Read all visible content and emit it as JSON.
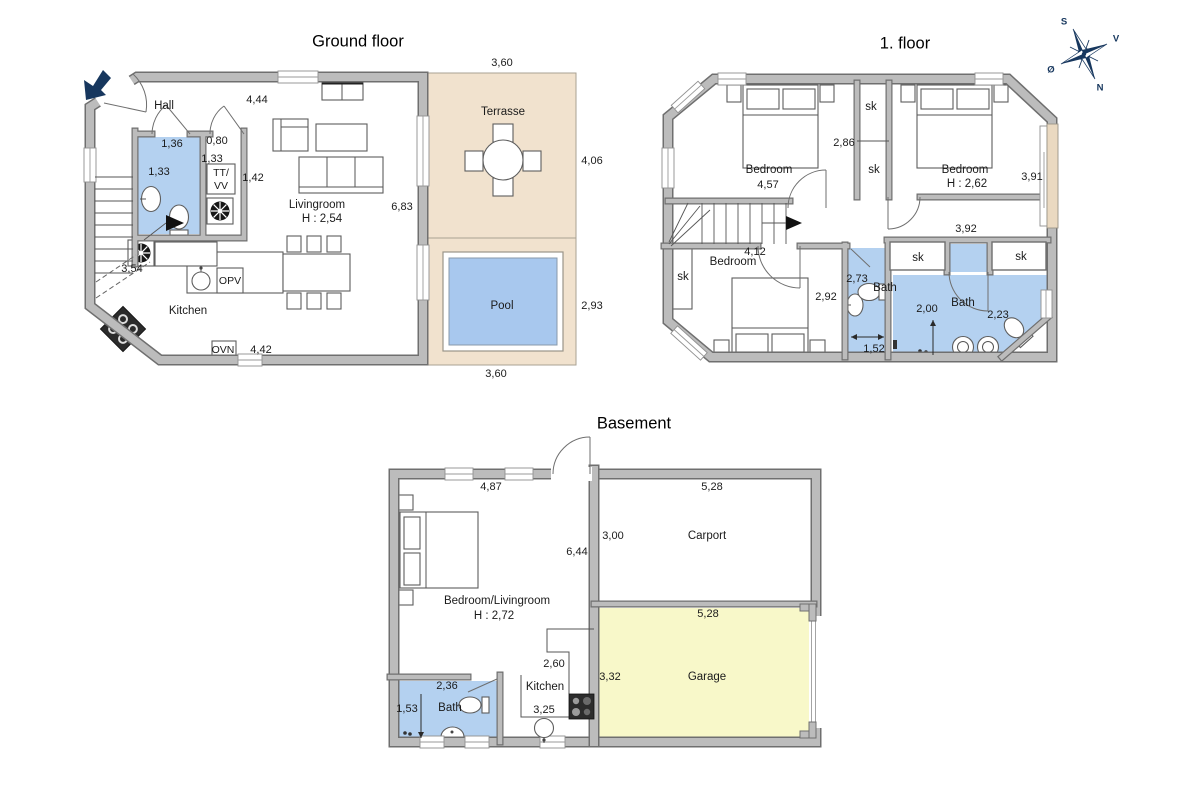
{
  "compass": {
    "north": "N",
    "south": "S",
    "east": "Ø",
    "west": "V"
  },
  "ground_floor": {
    "title": "Ground floor",
    "rooms": {
      "hall": "Hall",
      "livingroom": "Livingroom",
      "livingroom_height": "H : 2,54",
      "kitchen": "Kitchen",
      "terrace": "Terrasse",
      "pool": "Pool"
    },
    "appliances": {
      "dishwasher": "OPV",
      "oven": "OVN",
      "utility_top": "TT/",
      "utility_bottom": "VV"
    },
    "dims": {
      "top_wall": "4,44",
      "wc_width": "1,36",
      "wc_height": "1,33",
      "utility_width": "0,80",
      "utility_height": "1,33",
      "utility_right": "1,42",
      "living_right": "6,83",
      "left_wall": "3,54",
      "bottom_wall": "4,42",
      "terrace_top": "3,60",
      "terrace_right": "4,06",
      "pool_right": "2,93",
      "terrace_bottom": "3,60"
    }
  },
  "first_floor": {
    "title": "1. floor",
    "rooms": {
      "bedroom_top_left": "Bedroom",
      "bedroom_top_right": "Bedroom",
      "bedroom_top_right_height": "H : 2,62",
      "bedroom_bottom": "Bedroom",
      "bath_middle": "Bath",
      "bath_right": "Bath",
      "closet_1": "sk",
      "closet_2": "sk",
      "closet_3": "sk",
      "closet_4": "sk",
      "closet_5": "sk"
    },
    "dims": {
      "bedroom_tl_width": "4,57",
      "middle": "2,86",
      "bedroom_tr_right": "3,91",
      "hall_width": "4,12",
      "hall_right": "3,92",
      "bedroom_bottom_width": "2,92",
      "bath_middle_width": "2,73",
      "bath_middle_inner": "1,52",
      "bath_right_left": "2,00",
      "bath_right_inner": "2,23"
    }
  },
  "basement": {
    "title": "Basement",
    "rooms": {
      "main": "Bedroom/Livingroom",
      "main_height": "H : 2,72",
      "kitchen": "Kitchen",
      "bath": "Bath",
      "carport": "Carport",
      "garage": "Garage"
    },
    "dims": {
      "main_top": "4,87",
      "carport_top": "5,28",
      "carport_left": "3,00",
      "main_middle": "6,44",
      "garage_top": "5,28",
      "kitchen_upper": "2,60",
      "garage_left": "3,32",
      "bath_top": "2,36",
      "bath_left": "1,53",
      "kitchen_lower": "3,25"
    }
  },
  "colors": {
    "wall_fill": "#bcbcbc",
    "wall_edge": "#6f6f6f",
    "wet_room_blue": "#b4d1f0",
    "terrace_beige": "#f1e2ce",
    "window_tan": "#ead9c1",
    "pool_blue": "#a8c8ee",
    "garage_yellow": "#f8f8c9",
    "compass_navy": "#17375e"
  }
}
